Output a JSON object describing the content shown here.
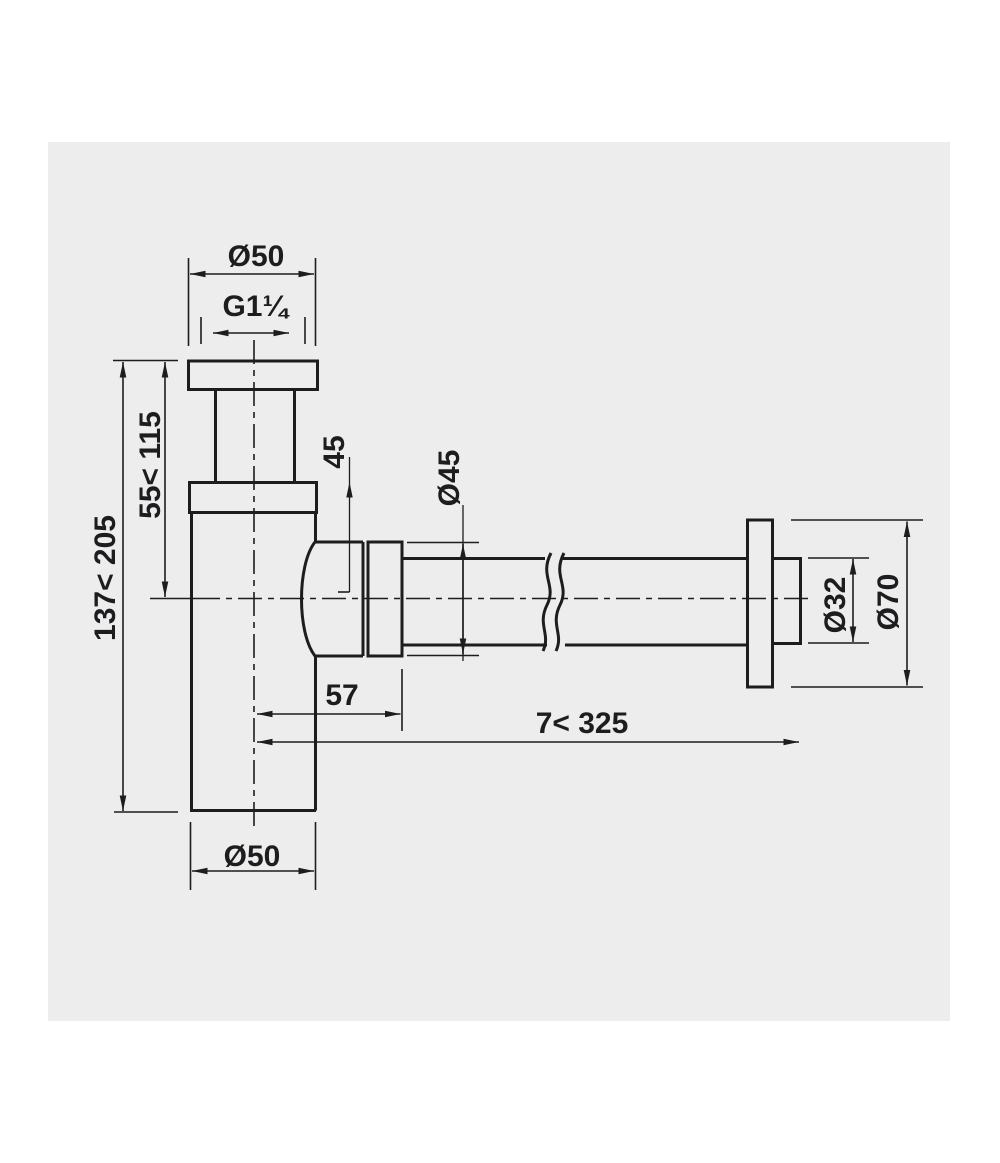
{
  "drawing": {
    "title": "bottle-trap-dimension-drawing",
    "labels": {
      "inlet_diameter": "Ø50",
      "thread": "G1¼",
      "height_inlet_to_outlet": "55< 115",
      "height_total": "137< 205",
      "outlet_center_offset": "45",
      "outlet_nut_diameter": "Ø45",
      "wall_pipe_diameter": "Ø32",
      "rosette_diameter": "Ø70",
      "center_to_nut_face": "57",
      "wall_tube_range": "7< 325",
      "body_diameter": "Ø50"
    },
    "colors": {
      "line": "#1d1d1f",
      "panel_background": "#ededee",
      "page_background": "#ffffff"
    }
  }
}
